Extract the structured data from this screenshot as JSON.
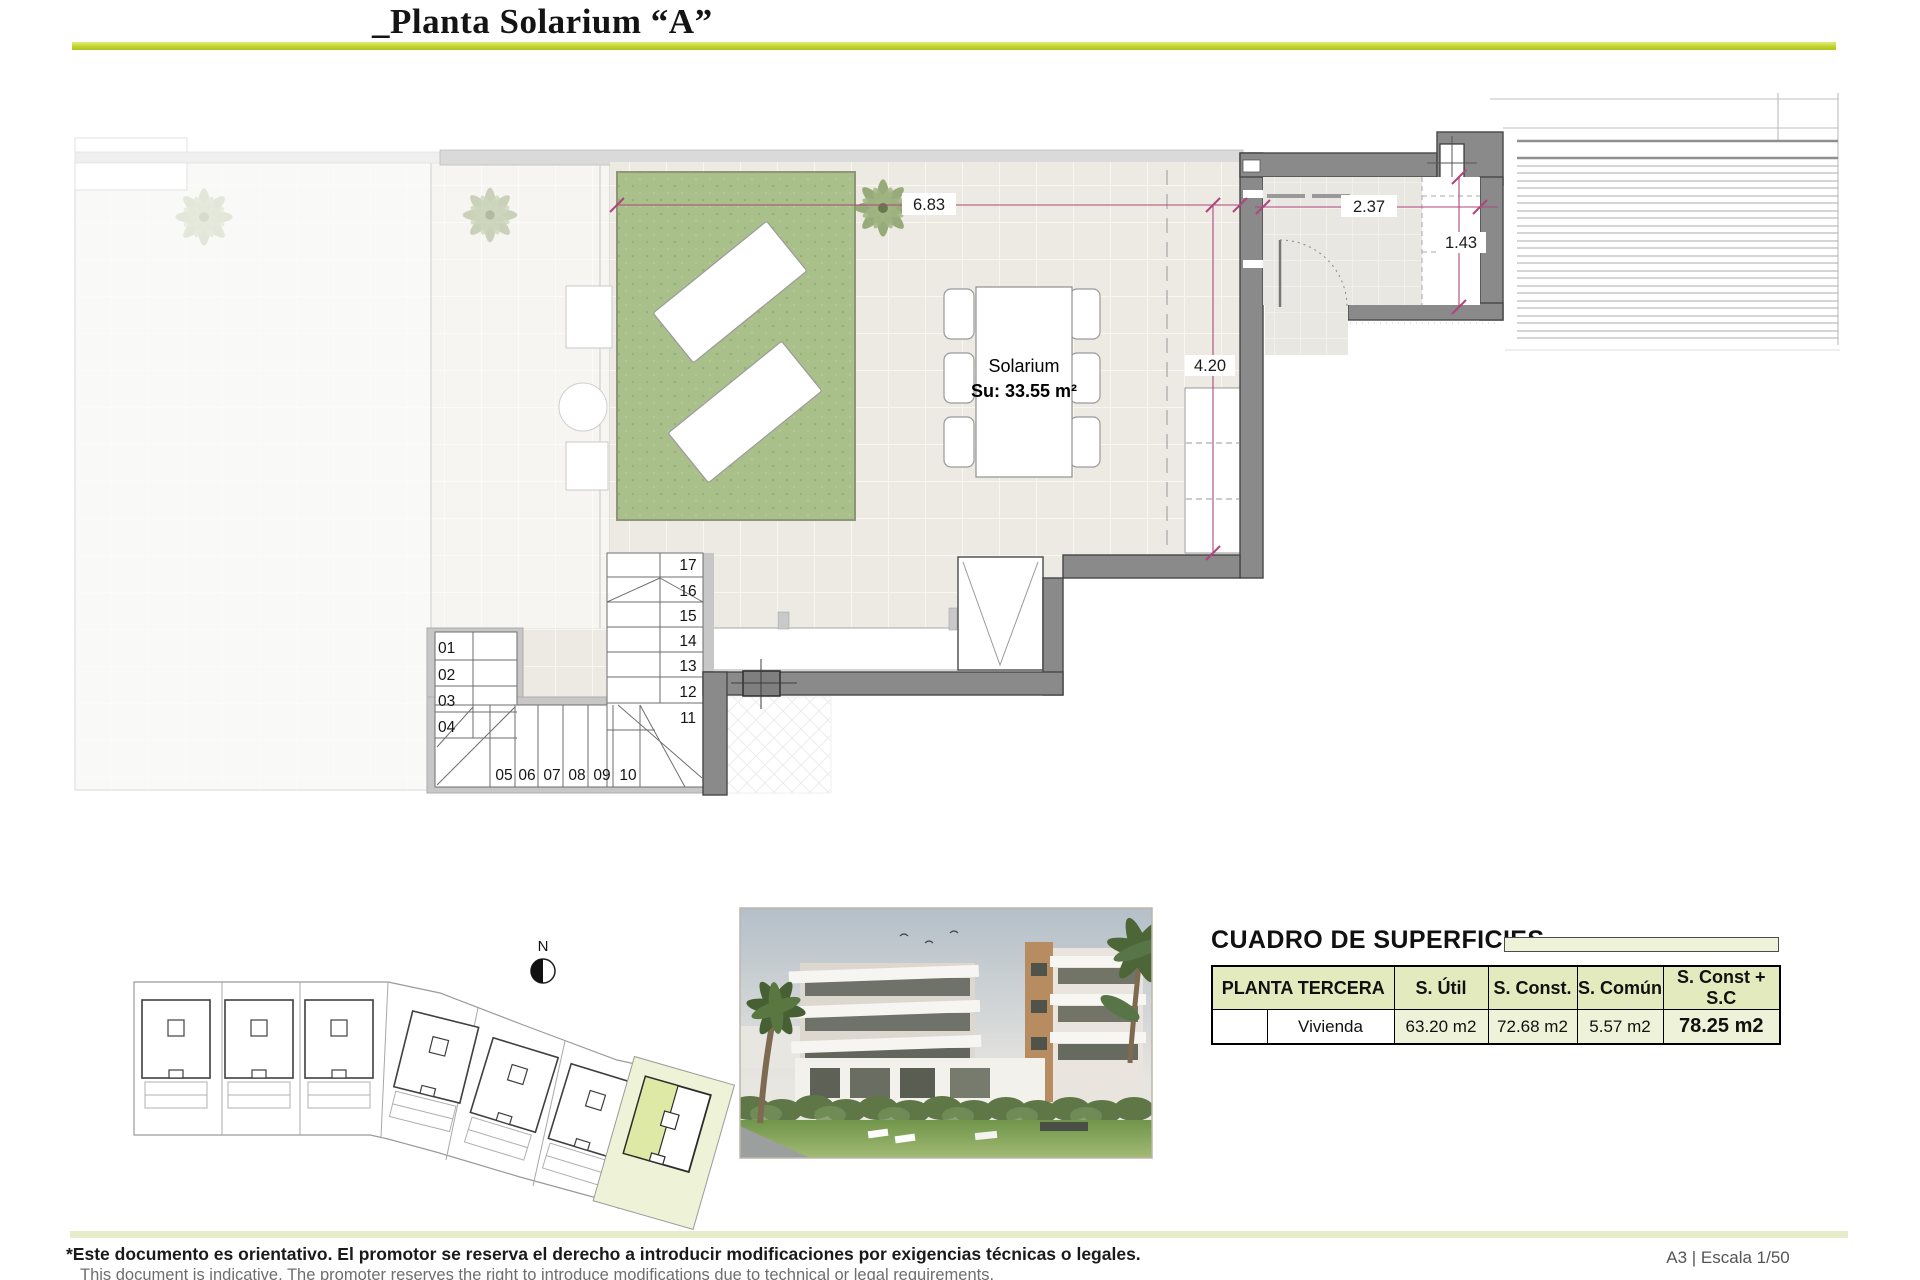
{
  "title": "_Planta Solarium “A”",
  "plan": {
    "room_label": "Solarium",
    "room_area": "Su: 33.55 m²",
    "dims": {
      "terrace_width": "6.83",
      "store_width": "2.37",
      "store_depth": "1.43",
      "terrace_depth": "4.20"
    },
    "stairs": [
      "01",
      "02",
      "03",
      "04",
      "05",
      "06",
      "07",
      "08",
      "09",
      "10",
      "11",
      "12",
      "13",
      "14",
      "15",
      "16",
      "17"
    ],
    "north_label": "N"
  },
  "surfaces": {
    "title": "CUADRO DE SUPERFICIES",
    "columns": [
      "PLANTA TERCERA",
      "S. Útil",
      "S. Const.",
      "S. Común",
      "S. Const + S.C"
    ],
    "rows": [
      {
        "label": "Vivienda",
        "s_util": "63.20 m2",
        "s_const": "72.68 m2",
        "s_comun": "5.57 m2",
        "total": "78.25 m2"
      }
    ]
  },
  "footer": {
    "disclaimer_es": "*Este documento es orientativo. El promotor se reserva el derecho a introducir modificaciones por exigencias técnicas o legales.",
    "disclaimer_en": "This document is indicative. The promoter reserves the right to introduce modifications due to technical or legal requirements.",
    "sheet_scale": "A3 | Escala 1/50"
  },
  "colors": {
    "accent": "#c2d32c",
    "accent_light": "#e7ecca",
    "wall": "#8a8a8a",
    "wall_dark": "#474747",
    "grass": "#a9c08b",
    "dim": "#b0457e",
    "tile": "#edeae3",
    "header_bg": "#e3eabd",
    "cell_bg": "#eef2d8",
    "highlight": "#dde9a4",
    "highlight_light": "#eef3d7"
  }
}
